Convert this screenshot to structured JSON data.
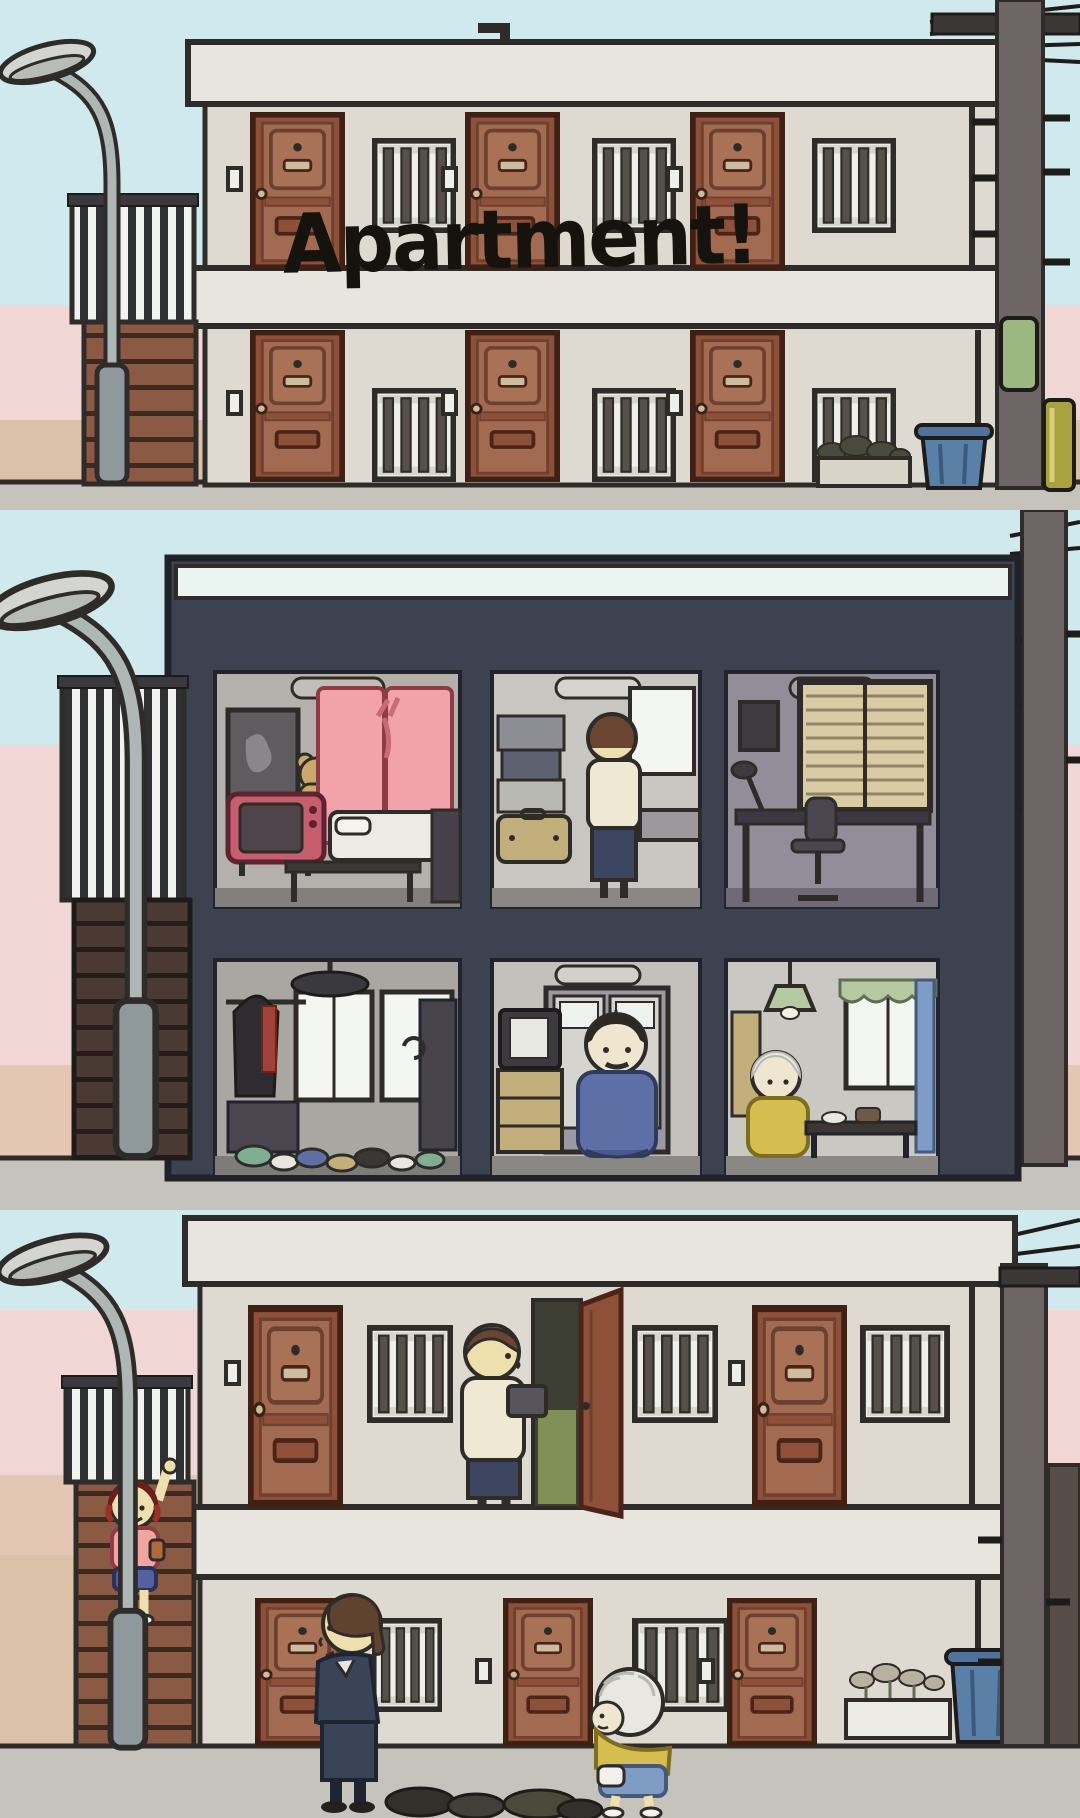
{
  "title": {
    "text": "Apartment!"
  },
  "scene": {
    "style": "hand-drawn cartoon, three stacked panels, dusk pastel sky",
    "panels": [
      {
        "name": "exterior-with-sign",
        "elements": [
          "street-lamp",
          "striped-fence",
          "staircase",
          "two-story-apartment-building",
          "brown-entrance-doors",
          "barred-windows",
          "doorbells",
          "roof-vent-pipe",
          "downspout",
          "utility-pole",
          "power-lines",
          "pole-sign",
          "gas-cylinder",
          "blue-trash-bin",
          "flower-planter"
        ]
      },
      {
        "name": "cutaway-interior",
        "rooms": [
          {
            "name": "living-room",
            "items": [
              "framed-picture",
              "teddy-bear",
              "retro-pink-tv",
              "pink-curtains",
              "futon-bed",
              "low-table",
              "dark-sofa"
            ]
          },
          {
            "name": "kitchen",
            "items": [
              "resident-at-counter",
              "stacked-boxes",
              "suitcase",
              "bright-window",
              "counter"
            ]
          },
          {
            "name": "office",
            "items": [
              "small-frame",
              "desk-lamp",
              "venetian-blinds",
              "desk",
              "office-chair"
            ]
          },
          {
            "name": "messy-room",
            "items": [
              "hanging-jacket",
              "red-scarf",
              "ceiling-lamp",
              "windows",
              "dark-shelf",
              "clutter-on-floor"
            ]
          },
          {
            "name": "tv-room",
            "items": [
              "tv-on-tan-dresser",
              "seated-man-with-mustache",
              "hallway-doors"
            ]
          },
          {
            "name": "grandma-room",
            "items": [
              "green-pendant-lamp",
              "old-lady",
              "low-table-with-dishes",
              "curtained-window",
              "blue-curtain"
            ]
          }
        ]
      },
      {
        "name": "exterior-with-residents",
        "elements": [
          "street-lamp",
          "striped-fence",
          "staircase",
          "waving-kid",
          "man-at-open-door",
          "open-door",
          "businessman-walking",
          "stooped-old-lady",
          "trash-bags",
          "flower-planter",
          "blue-trash-bin",
          "utility-pole"
        ]
      }
    ]
  },
  "palette": {
    "sky": "#cfe9ec",
    "sky_pink": "#f0d6d4",
    "sky_tan": "#d9c2a8",
    "ground": "#c6c3bd",
    "wall": "#dedad2",
    "slab": "#e8e5df",
    "outline": "#2e2b28",
    "door_brown": "#a26a50",
    "door_dark": "#8e5038",
    "bar_dark": "#55504a",
    "fence_dark": "#2f3034",
    "stair_brown": "#8a5a45",
    "stair_dark": "#4a3a33",
    "lamp_gray": "#aeb6b6",
    "utility_pole": "#6e6566",
    "cutaway_frame": "#3d4250",
    "room_gray": "#b4b1ac",
    "room_mauve": "#918d99",
    "curtain_pink": "#f2a2aa",
    "tv_pink": "#c75e6e",
    "bed_white": "#eceae4",
    "skin": "#eedfae",
    "hair_brown": "#6a4632",
    "navy": "#3c4660",
    "cream": "#efe8d2",
    "kid_hair": "#9e2f28",
    "kid_shirt": "#efa6a0",
    "kid_shorts": "#55609e",
    "grandma_yellow": "#d6bd4f",
    "grandma_skirt": "#7e9cc4",
    "bin_blue": "#5a80a8",
    "cylinder_olive": "#aaa23e",
    "sign_green": "#9cb77f",
    "curtain_green": "#b7c9a2"
  }
}
